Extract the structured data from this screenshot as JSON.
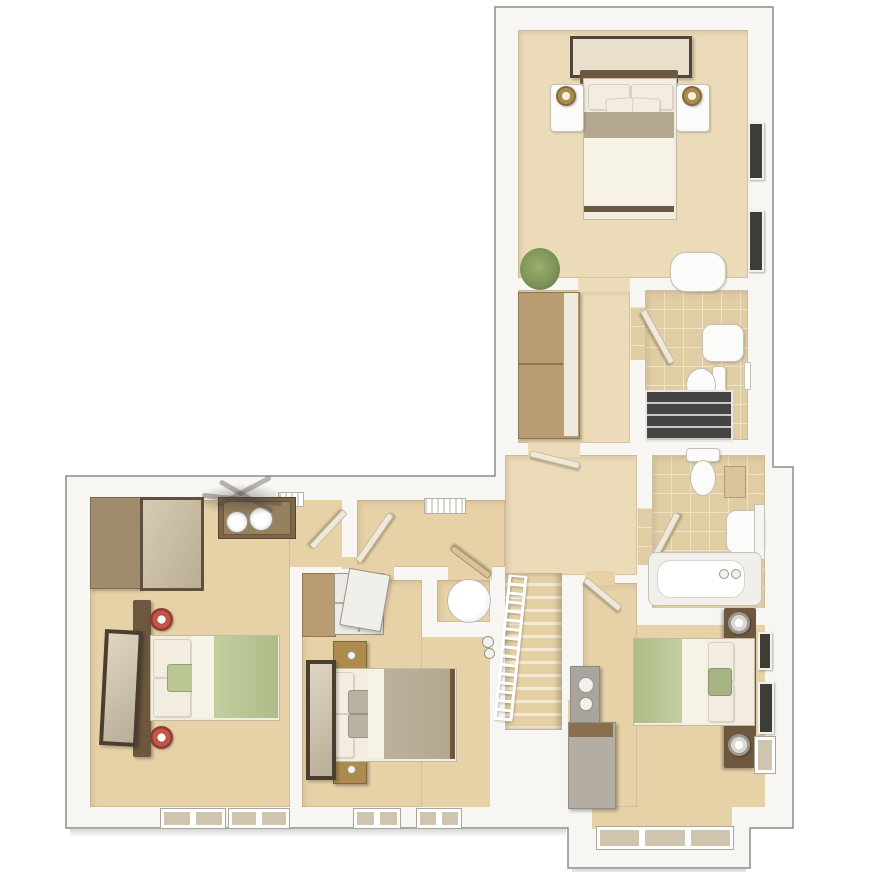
{
  "plan": {
    "kind": "3d-floor-plan",
    "view": "top-down dollhouse render",
    "rooms": [
      {
        "id": "master-bedroom",
        "furniture": [
          "double-bed",
          "bedside-table-left",
          "bedside-table-right",
          "brass-lamps",
          "wall-art",
          "wardrobe",
          "plant",
          "chair",
          "wall-windows"
        ]
      },
      {
        "id": "en-suite",
        "fixtures": [
          "shower",
          "basin",
          "toilet",
          "door"
        ]
      },
      {
        "id": "family-bathroom",
        "fixtures": [
          "bathtub",
          "basin",
          "toilet",
          "wall-shelf",
          "mirror",
          "door"
        ]
      },
      {
        "id": "landing",
        "features": [
          "staircase",
          "banister",
          "radiator"
        ]
      },
      {
        "id": "bedroom-2",
        "furniture": [
          "double-bed",
          "green-bedding",
          "red-lamps",
          "wardrobe-with-mirror",
          "dressing-table",
          "stools",
          "leaning-mirror",
          "ceiling-light",
          "windows"
        ]
      },
      {
        "id": "bedroom-3",
        "furniture": [
          "double-bed",
          "taupe-bedding",
          "brass-bedside-tables",
          "mirrored-wardrobe",
          "leaning-mirror",
          "windows"
        ]
      },
      {
        "id": "shower-room",
        "fixtures": [
          "round-basin",
          "door"
        ]
      },
      {
        "id": "bedroom-4",
        "furniture": [
          "double-bed",
          "green-bedding",
          "crystal-lamps",
          "headboard-shelf",
          "dresser",
          "wall-cabinet",
          "wall-frames",
          "bay-window"
        ]
      }
    ]
  },
  "palette": {
    "outline": "#8d8b88",
    "wall": "#f7f6f3",
    "carpet": "#e7d2a7",
    "carpet_light": "#ecdbb8",
    "tile": "#e0cda4",
    "grout": "#efe3c5",
    "wood": "#b89c72",
    "wood_mid": "#a08b6d",
    "wood_dark": "#6e573f",
    "wood_light": "#d9c49a",
    "wood_top": "#8a6f4f",
    "linen": "#f2ede0",
    "sheet": "#f6f2e6",
    "taupe": "#b3a78f",
    "green": "#b9c795",
    "green_dark": "#a6b383",
    "brass": "#ab8c4e",
    "red": "#c4544a",
    "grey_furn": "#b3ada3",
    "fixture": "#fbfbf9",
    "shower": "#454442",
    "plant": "#7d9155",
    "mirror": "#cfc4ad",
    "frame_dark": "#52453a",
    "glass": "#cfc4ad"
  }
}
